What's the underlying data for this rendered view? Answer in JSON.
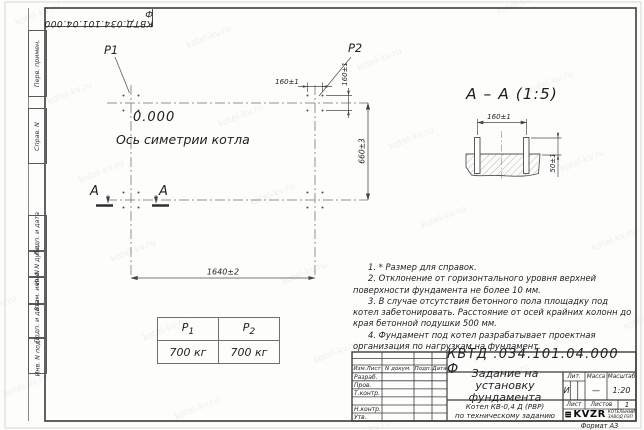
{
  "watermark": {
    "text": "kotel-kv.ru"
  },
  "stamp_top": {
    "text": "КВТД.034.101.04.000 Ф"
  },
  "side_labels": {
    "items": [
      "Перв. примен.",
      "Справ. N",
      "Подп. и дата",
      "Инв. N дубл.",
      "Взам. инв. N",
      "Подп. и дата",
      "Инв. N подл."
    ]
  },
  "plan": {
    "p1": "P1",
    "p2": "P2",
    "level": "0.000",
    "axis_label": "Ось симетрии котла",
    "dim_width": "1640±2",
    "dim_height": "660±3",
    "dim_bolt_x": "160±1",
    "dim_bolt_y": "160±1",
    "cut_letter": "А"
  },
  "section": {
    "title": "А – А (1:5)",
    "dim_spacing": "160±1",
    "dim_height": "50±1"
  },
  "load_table": {
    "p1_name": "P",
    "p1_sub": "1",
    "p2_name": "P",
    "p2_sub": "2",
    "p1_value": "700 кг",
    "p2_value": "700 кг"
  },
  "notes": {
    "items": [
      "1. * Размер для справок.",
      "2. Отклонение от горизонтального уровня верхней поверхности фундамента не более 10 мм.",
      "3. В случае отсутствия бетонного пола площадку под котел забетонировать. Расстояние от осей крайних колонн до края бетонной подушки 500 мм.",
      "4. Фундамент под котел разрабатывает проектная организация по нагрузкам на фундамент."
    ]
  },
  "title_block": {
    "designation": "КВТД .034.101.04.000  Ф",
    "doc_title": "Задание на установку фундамента",
    "rev_headers": [
      "Изм.Лист",
      "N докум.",
      "Подп.",
      "Дата"
    ],
    "sign_labels": [
      "Разраб.",
      "Пров.",
      "Т.контр.",
      "Н.контр.",
      "Утв."
    ],
    "lit_label": "Лит.",
    "mass_label": "Масса",
    "scale_label": "Масштаб",
    "lit_value": "И",
    "mass_value": "—",
    "scale_value": "1:20",
    "sheet_label": "Лист",
    "sheets_label": "Листов",
    "sheets_value": "1",
    "product_line1": "Котел КВ-0,4 Д (РВР)",
    "product_line2": "по техническому заданию",
    "logo_text": "KVZR",
    "logo_sub1": "КОТЕЛЬНЫЙ",
    "logo_sub2": "ЗАВОД РЭП",
    "format": "Формат А3"
  }
}
